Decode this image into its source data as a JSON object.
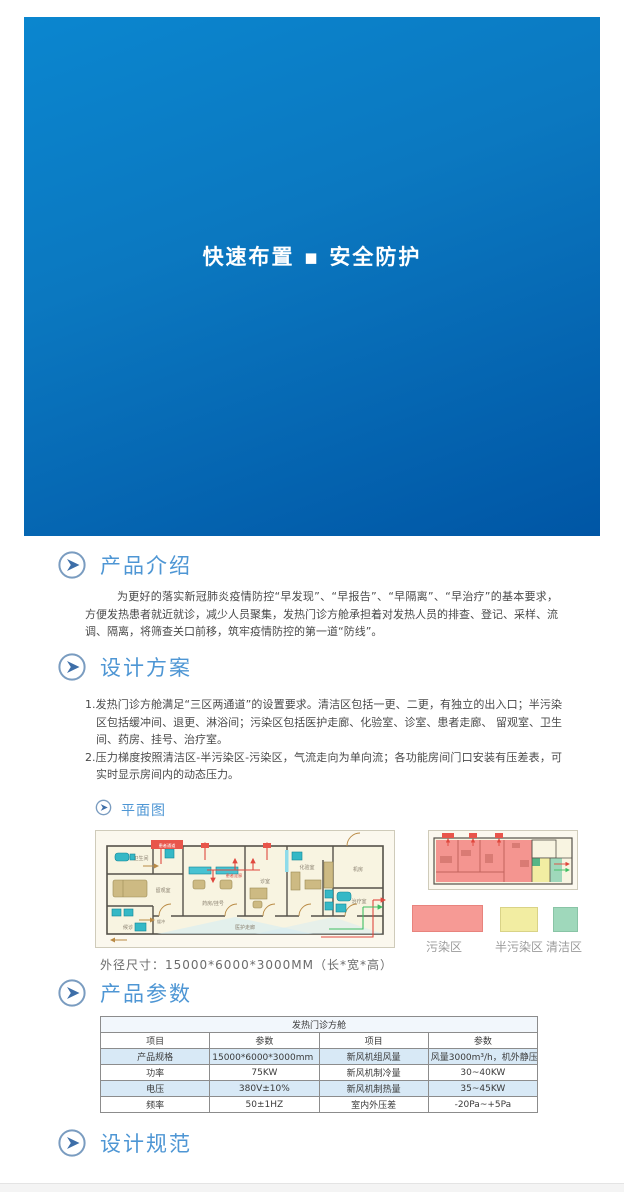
{
  "banner": {
    "title": "快速布置 ▪ 安全防护"
  },
  "intro": {
    "title": "产品介绍",
    "body": "为更好的落实新冠肺炎疫情防控“早发现”、“早报告”、“早隔离”、“早治疗”的基本要求，方便发热患者就近就诊，减少人员聚集，发热门诊方舱承担着对发热人员的排查、登记、采样、流调、隔离，将筛查关口前移，筑牢疫情防控的第一道“防线”。"
  },
  "design": {
    "title": "设计方案",
    "items": [
      "1.发热门诊方舱满足“三区两通道”的设置要求。清洁区包括一更、二更，有独立的出入口；半污染区包括缓冲间、退更、淋浴间；污染区包括医护走廊、化验室、诊室、患者走廊、 留观室、卫生间、药房、挂号、治疗室。",
      "2.压力梯度按照清洁区-半污染区-污染区，气流走向为单向流；各功能房间门口安装有压差表，可实时显示房间内的动态压力。"
    ]
  },
  "floorplan": {
    "title": "平面图",
    "rooms": {
      "toilet": "卫生间",
      "ward": "留观室",
      "waiting": "候诊",
      "buffer": "缓冲",
      "pharmacy": "药房/挂号",
      "clinic": "诊室",
      "lab": "化验室",
      "treatment": "治疗室",
      "equipment": "机房",
      "corridor": "医护走廊",
      "patient_channel": "患者通道",
      "patient_corridor": "患者走廊"
    },
    "legend": [
      {
        "label": "污染区",
        "color": "#F69A95"
      },
      {
        "label": "半污染区",
        "color": "#F2EDA2"
      },
      {
        "label": "清洁区",
        "color": "#9FD8BB"
      }
    ],
    "dimension_note": "外径尺寸：15000*6000*3000MM（长*宽*高）"
  },
  "params": {
    "title": "产品参数",
    "table": {
      "title": "发热门诊方舱",
      "headers": [
        "项目",
        "参数",
        "项目",
        "参数"
      ],
      "rows": [
        [
          "产品规格",
          "15000*6000*3000mm（长*宽*高）",
          "新风机组风量",
          "风量3000m³/h，机外静压350Pa"
        ],
        [
          "功率",
          "75KW",
          "新风机制冷量",
          "30~40KW"
        ],
        [
          "电压",
          "380V±10%",
          "新风机制热量",
          "35~45KW"
        ],
        [
          "频率",
          "50±1HZ",
          "室内外压差",
          "-20Pa~+5Pa"
        ]
      ]
    }
  },
  "spec": {
    "title": "设计规范"
  },
  "colors": {
    "banner_top": "#0B86CF",
    "banner_bottom": "#0056A5",
    "heading": "#4E96D4",
    "table_alt_row": "#D8E9F6"
  }
}
